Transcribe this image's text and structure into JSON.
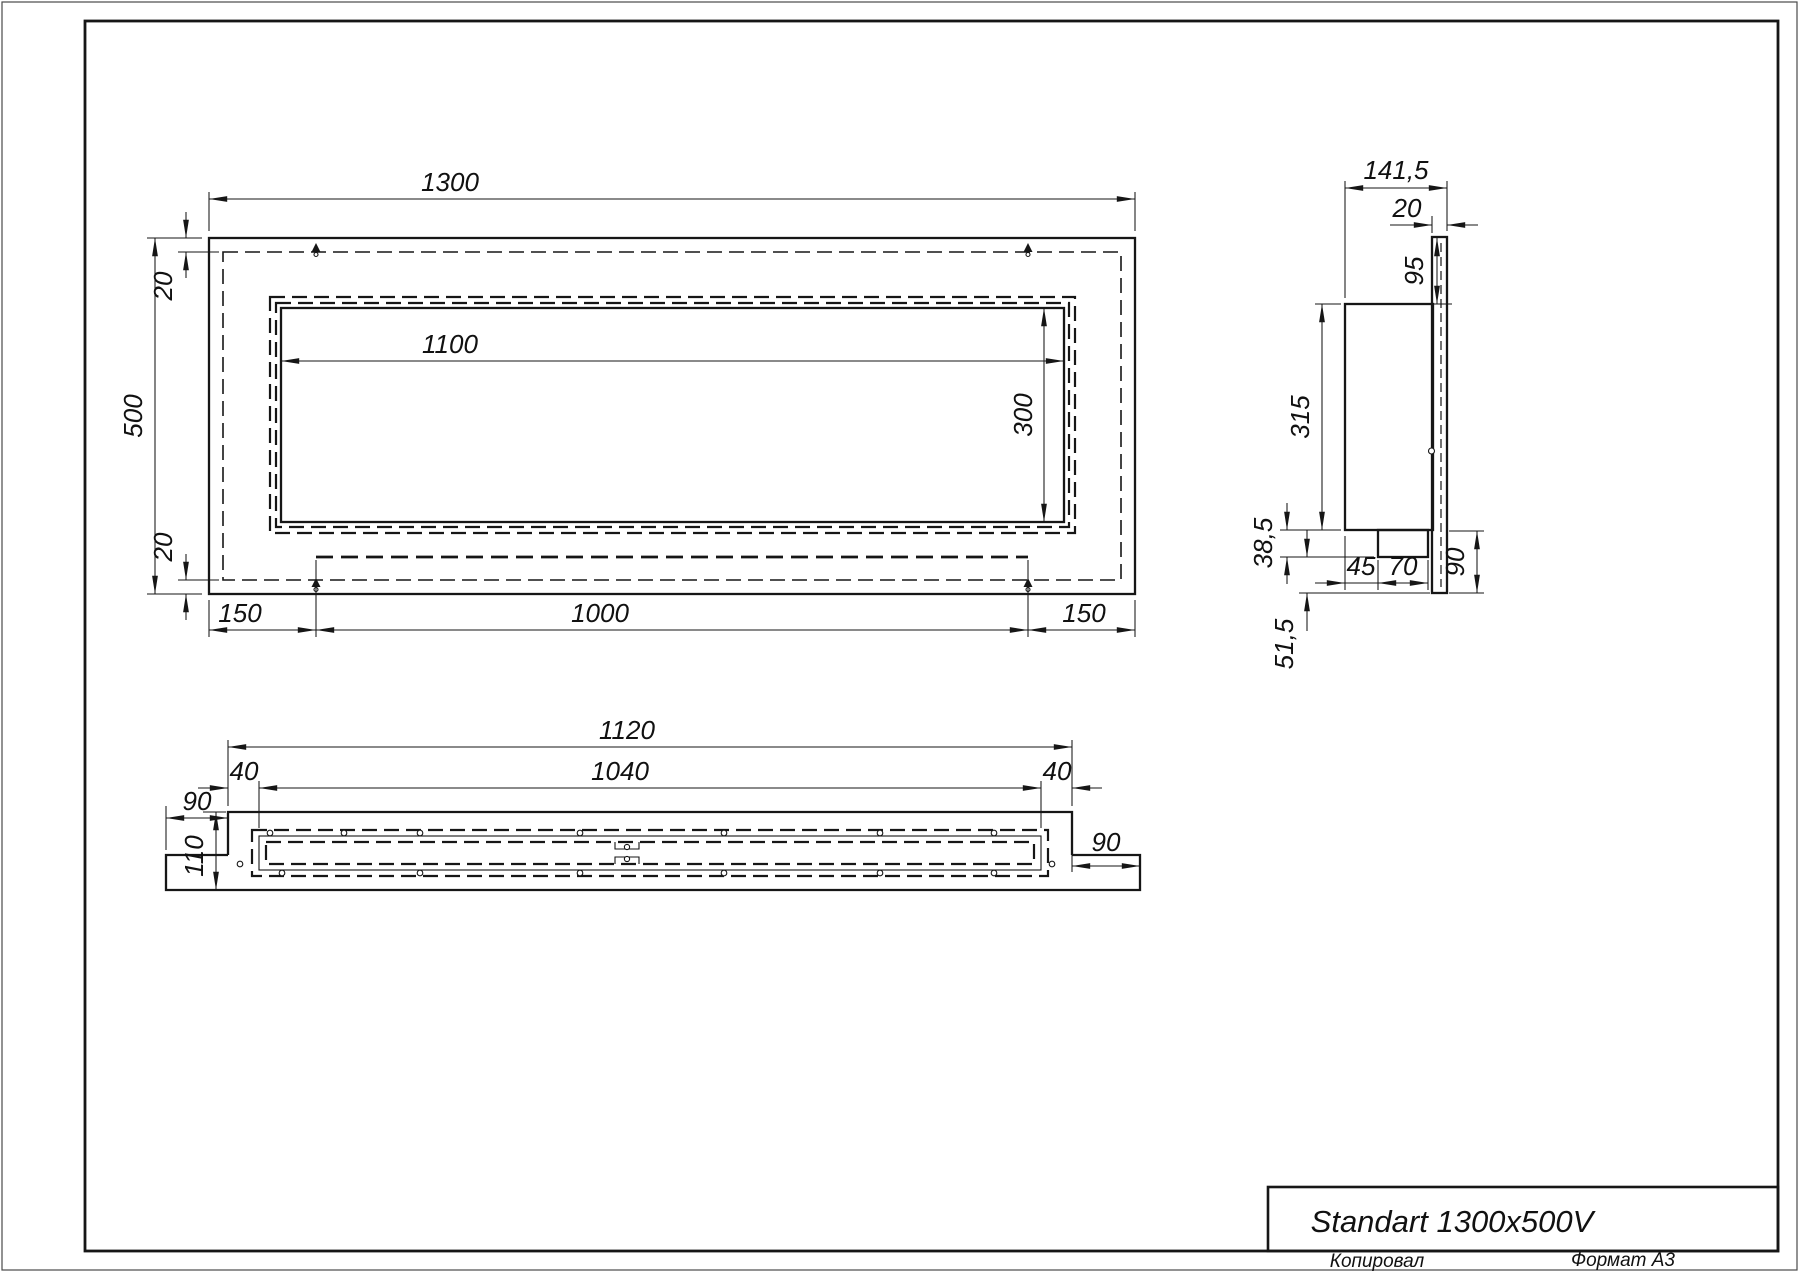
{
  "sheet": {
    "title": "Standart 1300x500V",
    "copied_label": "Копировал",
    "format_label": "Формат А3"
  },
  "front_view": {
    "dims": {
      "overall_width": "1300",
      "overall_height": "500",
      "opening_width": "1100",
      "opening_height": "300",
      "top_inset": "20",
      "bottom_inset": "20",
      "bottom_left": "150",
      "bottom_center": "1000",
      "bottom_right": "150"
    }
  },
  "side_view": {
    "dims": {
      "overall_depth": "141,5",
      "back_plate": "20",
      "top_offset": "95",
      "body_height": "315",
      "tray_drop": "38,5",
      "lower_drop": "51,5",
      "tray_inset": "45",
      "tray_width": "70",
      "bottom_flange": "90"
    }
  },
  "bottom_view": {
    "dims": {
      "overall_width": "1120",
      "inner_width": "1040",
      "left_margin": "40",
      "right_margin": "40",
      "left_flange": "90",
      "right_flange": "90",
      "depth": "110"
    }
  }
}
